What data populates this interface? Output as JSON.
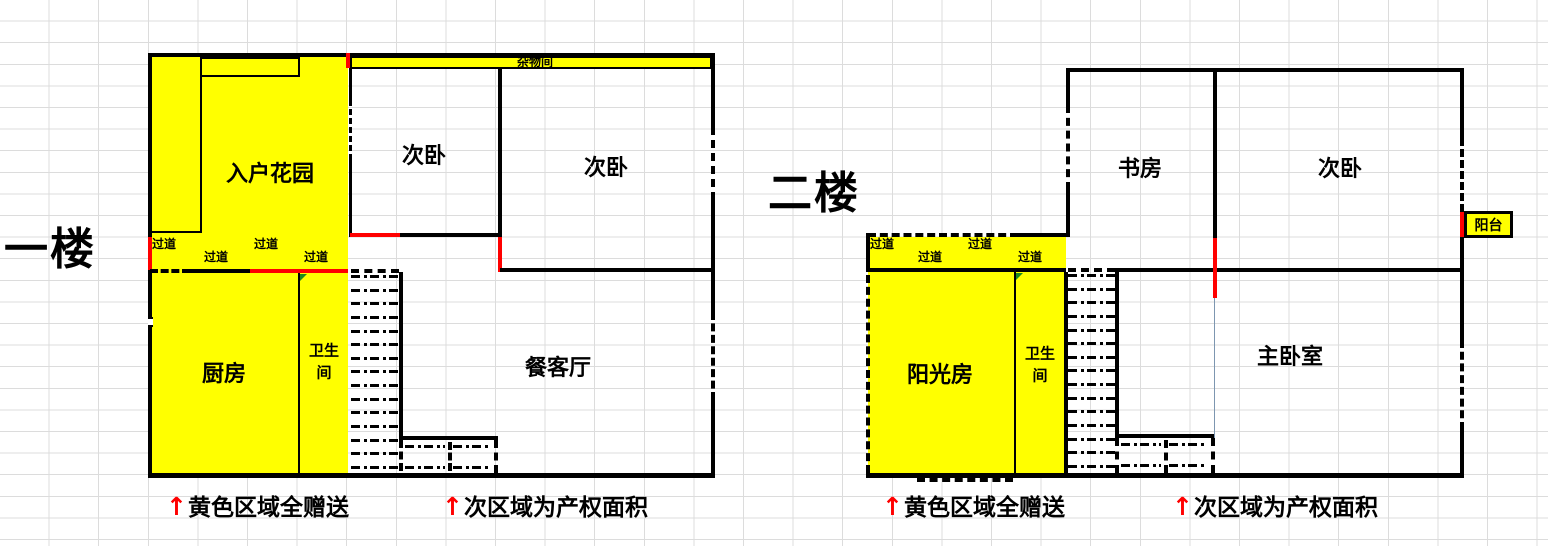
{
  "colors": {
    "gifted_area": "#ffff00",
    "wall": "#000000",
    "door_marker": "#ff0000",
    "note_arrow": "#ff0000"
  },
  "floor1": {
    "title": "一楼",
    "rooms": {
      "entry_garden": "入户花园",
      "storage": "杂物间",
      "bedroom_left": "次卧",
      "bedroom_right": "次卧",
      "kitchen": "厨房",
      "bathroom_line1": "卫生",
      "bathroom_line2": "间",
      "living_dining": "餐客厅"
    },
    "corridors": [
      "过道",
      "过道",
      "过道",
      "过道"
    ],
    "notes": [
      {
        "arrow": "↑",
        "text": "黄色区域全赠送"
      },
      {
        "arrow": "↑",
        "text": "次区域为产权面积"
      }
    ]
  },
  "floor2": {
    "title": "二楼",
    "rooms": {
      "study": "书房",
      "bedroom": "次卧",
      "balcony": "阳台",
      "sunroom": "阳光房",
      "bathroom_line1": "卫生",
      "bathroom_line2": "间",
      "master_bedroom": "主卧室"
    },
    "corridors": [
      "过道",
      "过道",
      "过道",
      "过道"
    ],
    "notes": [
      {
        "arrow": "↑",
        "text": "黄色区域全赠送"
      },
      {
        "arrow": "↑",
        "text": "次区域为产权面积"
      }
    ]
  }
}
